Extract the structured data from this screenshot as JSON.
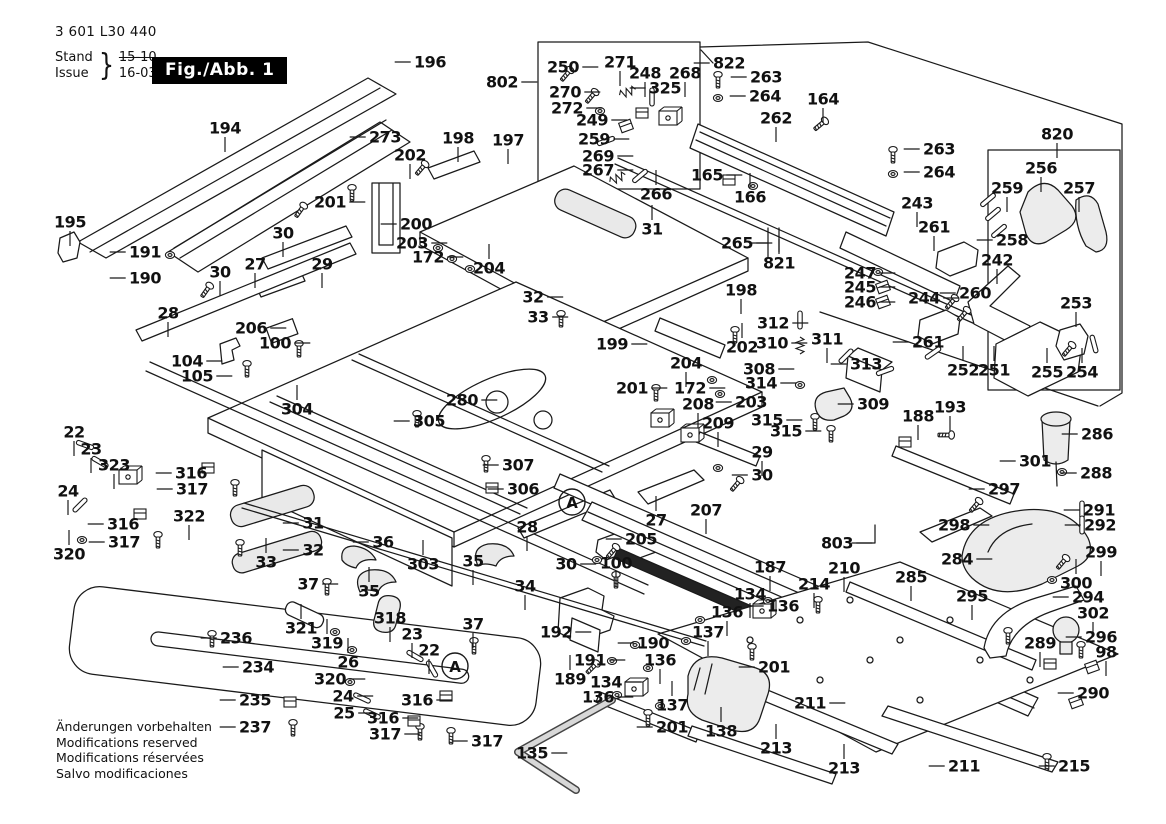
{
  "header": {
    "part_number": "3 601 L30 440",
    "stand_label": "Stand",
    "issue_label": "Issue",
    "brace": "}",
    "stand_value": "15-10",
    "issue_value": "16-03-10",
    "fig_label": "Fig./Abb. 1"
  },
  "footer": {
    "lines": [
      "Änderungen vorbehalten",
      "Modifications reserved",
      "Modifications réservées",
      "Salvo modificaciones"
    ]
  },
  "diagram": {
    "stroke_color": "#1a1a1a",
    "labels": [
      [
        "194",
        225,
        128,
        "d"
      ],
      [
        "196",
        430,
        62,
        "l"
      ],
      [
        "273",
        385,
        137,
        "l"
      ],
      [
        "202",
        410,
        155,
        "d"
      ],
      [
        "198",
        458,
        138,
        "d"
      ],
      [
        "197",
        508,
        140,
        "d"
      ],
      [
        "201",
        330,
        202,
        "r"
      ],
      [
        "200",
        416,
        224,
        "l"
      ],
      [
        "30",
        283,
        233,
        "d"
      ],
      [
        "203",
        412,
        243,
        "r"
      ],
      [
        "172",
        428,
        257,
        "r"
      ],
      [
        "204",
        489,
        268,
        "u"
      ],
      [
        "27",
        255,
        264,
        "d"
      ],
      [
        "29",
        322,
        264,
        "d"
      ],
      [
        "30",
        220,
        272,
        "d"
      ],
      [
        "195",
        70,
        222,
        "d"
      ],
      [
        "191",
        145,
        252,
        "l"
      ],
      [
        "190",
        145,
        278,
        "l"
      ],
      [
        "28",
        168,
        313,
        "d"
      ],
      [
        "206",
        251,
        328,
        "r"
      ],
      [
        "104",
        187,
        361,
        "r"
      ],
      [
        "105",
        197,
        376,
        "r"
      ],
      [
        "100",
        275,
        343,
        "r"
      ],
      [
        "802",
        502,
        82,
        "r"
      ],
      [
        "250",
        563,
        67,
        "r"
      ],
      [
        "271",
        620,
        62,
        "d"
      ],
      [
        "248",
        645,
        73,
        "d"
      ],
      [
        "268",
        685,
        73,
        "d"
      ],
      [
        "325",
        665,
        88,
        "l"
      ],
      [
        "270",
        565,
        92,
        "r"
      ],
      [
        "272",
        567,
        108,
        "r"
      ],
      [
        "249",
        592,
        120,
        "r"
      ],
      [
        "259",
        594,
        139,
        "r"
      ],
      [
        "269",
        598,
        156,
        "r"
      ],
      [
        "267",
        598,
        170,
        "r"
      ],
      [
        "266",
        656,
        194,
        "u"
      ],
      [
        "165",
        707,
        175,
        "r"
      ],
      [
        "166",
        750,
        197,
        "u"
      ],
      [
        "822",
        729,
        63,
        "l"
      ],
      [
        "263",
        766,
        77,
        "l"
      ],
      [
        "264",
        765,
        96,
        "l"
      ],
      [
        "164",
        823,
        99,
        "d"
      ],
      [
        "262",
        776,
        118,
        "d"
      ],
      [
        "820",
        1057,
        134,
        "d"
      ],
      [
        "263",
        939,
        149,
        "l"
      ],
      [
        "264",
        939,
        172,
        "l"
      ],
      [
        "243",
        917,
        203,
        "d"
      ],
      [
        "261",
        934,
        227,
        "d"
      ],
      [
        "256",
        1041,
        168,
        "d"
      ],
      [
        "259",
        1007,
        188,
        "d"
      ],
      [
        "257",
        1079,
        188,
        "d"
      ],
      [
        "258",
        1012,
        240,
        "l"
      ],
      [
        "242",
        997,
        260,
        "d"
      ],
      [
        "247",
        860,
        273,
        "r"
      ],
      [
        "245",
        860,
        287,
        "r"
      ],
      [
        "246",
        860,
        302,
        "r"
      ],
      [
        "244",
        924,
        298,
        "r"
      ],
      [
        "260",
        975,
        293,
        "l"
      ],
      [
        "261",
        928,
        342,
        "l"
      ],
      [
        "253",
        1076,
        303,
        "d"
      ],
      [
        "252",
        963,
        370,
        "u"
      ],
      [
        "251",
        994,
        370,
        "u"
      ],
      [
        "255",
        1047,
        372,
        "u"
      ],
      [
        "254",
        1082,
        372,
        "u"
      ],
      [
        "265",
        737,
        243,
        "r"
      ],
      [
        "821",
        779,
        263,
        "u"
      ],
      [
        "31",
        652,
        229,
        "u"
      ],
      [
        "32",
        533,
        297,
        "r"
      ],
      [
        "33",
        538,
        317,
        "r"
      ],
      [
        "198",
        741,
        290,
        "d"
      ],
      [
        "199",
        612,
        344,
        "r"
      ],
      [
        "202",
        742,
        347,
        "u"
      ],
      [
        "204",
        686,
        363,
        "d"
      ],
      [
        "172",
        690,
        388,
        "r"
      ],
      [
        "203",
        751,
        402,
        "l"
      ],
      [
        "201",
        632,
        388,
        "r"
      ],
      [
        "208",
        698,
        404,
        "d"
      ],
      [
        "209",
        718,
        423,
        "d"
      ],
      [
        "312",
        773,
        323,
        "r"
      ],
      [
        "310",
        772,
        343,
        "r"
      ],
      [
        "311",
        827,
        339,
        "d"
      ],
      [
        "313",
        866,
        364,
        "l"
      ],
      [
        "308",
        759,
        369,
        "r"
      ],
      [
        "314",
        761,
        383,
        "r"
      ],
      [
        "309",
        873,
        404,
        "l"
      ],
      [
        "315",
        767,
        420,
        "r"
      ],
      [
        "315",
        786,
        431,
        "r"
      ],
      [
        "188",
        918,
        416,
        "d"
      ],
      [
        "193",
        950,
        407,
        "d"
      ],
      [
        "29",
        762,
        452,
        "d"
      ],
      [
        "30",
        762,
        475,
        "l"
      ],
      [
        "301",
        1035,
        461,
        "l"
      ],
      [
        "304",
        297,
        409,
        "u"
      ],
      [
        "305",
        429,
        421,
        "l"
      ],
      [
        "280",
        462,
        400,
        "r"
      ],
      [
        "307",
        518,
        465,
        "l"
      ],
      [
        "306",
        523,
        489,
        "l"
      ],
      [
        "28",
        527,
        527,
        "d"
      ],
      [
        "27",
        656,
        520,
        "u"
      ],
      [
        "205",
        641,
        539,
        "l"
      ],
      [
        "100",
        616,
        563,
        "d"
      ],
      [
        "30",
        566,
        564,
        "r"
      ],
      [
        "207",
        706,
        510,
        "d"
      ],
      [
        "187",
        770,
        567,
        "d"
      ],
      [
        "34",
        525,
        586,
        "d"
      ],
      [
        "35",
        473,
        561,
        "d"
      ],
      [
        "35",
        369,
        591,
        "u"
      ],
      [
        "36",
        383,
        542,
        "l"
      ],
      [
        "303",
        423,
        564,
        "u"
      ],
      [
        "31",
        313,
        523,
        "l"
      ],
      [
        "32",
        313,
        550,
        "l"
      ],
      [
        "33",
        266,
        562,
        "u"
      ],
      [
        "37",
        308,
        584,
        "r"
      ],
      [
        "37",
        473,
        624,
        "d"
      ],
      [
        "22",
        74,
        432,
        "d"
      ],
      [
        "23",
        91,
        449,
        "d"
      ],
      [
        "323",
        114,
        465,
        "d"
      ],
      [
        "316",
        191,
        473,
        "l"
      ],
      [
        "317",
        192,
        489,
        "l"
      ],
      [
        "24",
        68,
        491,
        "d"
      ],
      [
        "316",
        123,
        524,
        "l"
      ],
      [
        "317",
        124,
        542,
        "l"
      ],
      [
        "320",
        69,
        554,
        "u"
      ],
      [
        "322",
        189,
        516,
        "d"
      ],
      [
        "236",
        236,
        638,
        "l"
      ],
      [
        "234",
        258,
        667,
        "l"
      ],
      [
        "235",
        255,
        700,
        "l"
      ],
      [
        "237",
        255,
        727,
        "l"
      ],
      [
        "321",
        301,
        628,
        "u"
      ],
      [
        "319",
        327,
        643,
        "u"
      ],
      [
        "26",
        348,
        662,
        "u"
      ],
      [
        "320",
        330,
        679,
        "r"
      ],
      [
        "24",
        343,
        696,
        "r"
      ],
      [
        "25",
        344,
        713,
        "r"
      ],
      [
        "318",
        390,
        618,
        "d"
      ],
      [
        "23",
        412,
        634,
        "d"
      ],
      [
        "22",
        429,
        650,
        "d"
      ],
      [
        "316",
        417,
        700,
        "r"
      ],
      [
        "316",
        383,
        718,
        "r"
      ],
      [
        "317",
        385,
        734,
        "r"
      ],
      [
        "317",
        487,
        741,
        "l"
      ],
      [
        "192",
        556,
        632,
        "r"
      ],
      [
        "190",
        653,
        643,
        "l"
      ],
      [
        "191",
        590,
        660,
        "r"
      ],
      [
        "189",
        570,
        679,
        "u"
      ],
      [
        "134",
        606,
        682,
        "r"
      ],
      [
        "136",
        598,
        697,
        "r"
      ],
      [
        "136",
        660,
        660,
        "d"
      ],
      [
        "137",
        672,
        705,
        "u"
      ],
      [
        "201",
        672,
        727,
        "l"
      ],
      [
        "135",
        532,
        753,
        "r"
      ],
      [
        "138",
        721,
        731,
        "u"
      ],
      [
        "134",
        750,
        594,
        "d"
      ],
      [
        "136",
        727,
        612,
        "d"
      ],
      [
        "136",
        783,
        606,
        "l"
      ],
      [
        "137",
        708,
        632,
        "d"
      ],
      [
        "201",
        774,
        667,
        "l"
      ],
      [
        "214",
        814,
        584,
        "d"
      ],
      [
        "210",
        844,
        568,
        "d"
      ],
      [
        "803",
        837,
        543,
        "r"
      ],
      [
        "211",
        810,
        703,
        "r"
      ],
      [
        "213",
        776,
        748,
        "u"
      ],
      [
        "213",
        844,
        768,
        "u"
      ],
      [
        "211",
        964,
        766,
        "l"
      ],
      [
        "215",
        1074,
        766,
        "l"
      ],
      [
        "297",
        1004,
        489,
        "l"
      ],
      [
        "298",
        954,
        525,
        "r"
      ],
      [
        "284",
        957,
        559,
        "r"
      ],
      [
        "295",
        972,
        596,
        "d"
      ],
      [
        "285",
        911,
        577,
        "d"
      ],
      [
        "286",
        1097,
        434,
        "l"
      ],
      [
        "288",
        1096,
        473,
        "l"
      ],
      [
        "291",
        1099,
        510,
        "l"
      ],
      [
        "292",
        1100,
        525,
        "l"
      ],
      [
        "299",
        1101,
        552,
        "d"
      ],
      [
        "300",
        1076,
        583,
        "u"
      ],
      [
        "294",
        1088,
        597,
        "l"
      ],
      [
        "302",
        1093,
        613,
        "d"
      ],
      [
        "289",
        1040,
        643,
        "d"
      ],
      [
        "296",
        1101,
        637,
        "l"
      ],
      [
        "98",
        1106,
        652,
        "d"
      ],
      [
        "290",
        1093,
        693,
        "l"
      ]
    ],
    "circled": [
      [
        "A",
        572,
        502
      ],
      [
        "A",
        455,
        666
      ]
    ]
  }
}
